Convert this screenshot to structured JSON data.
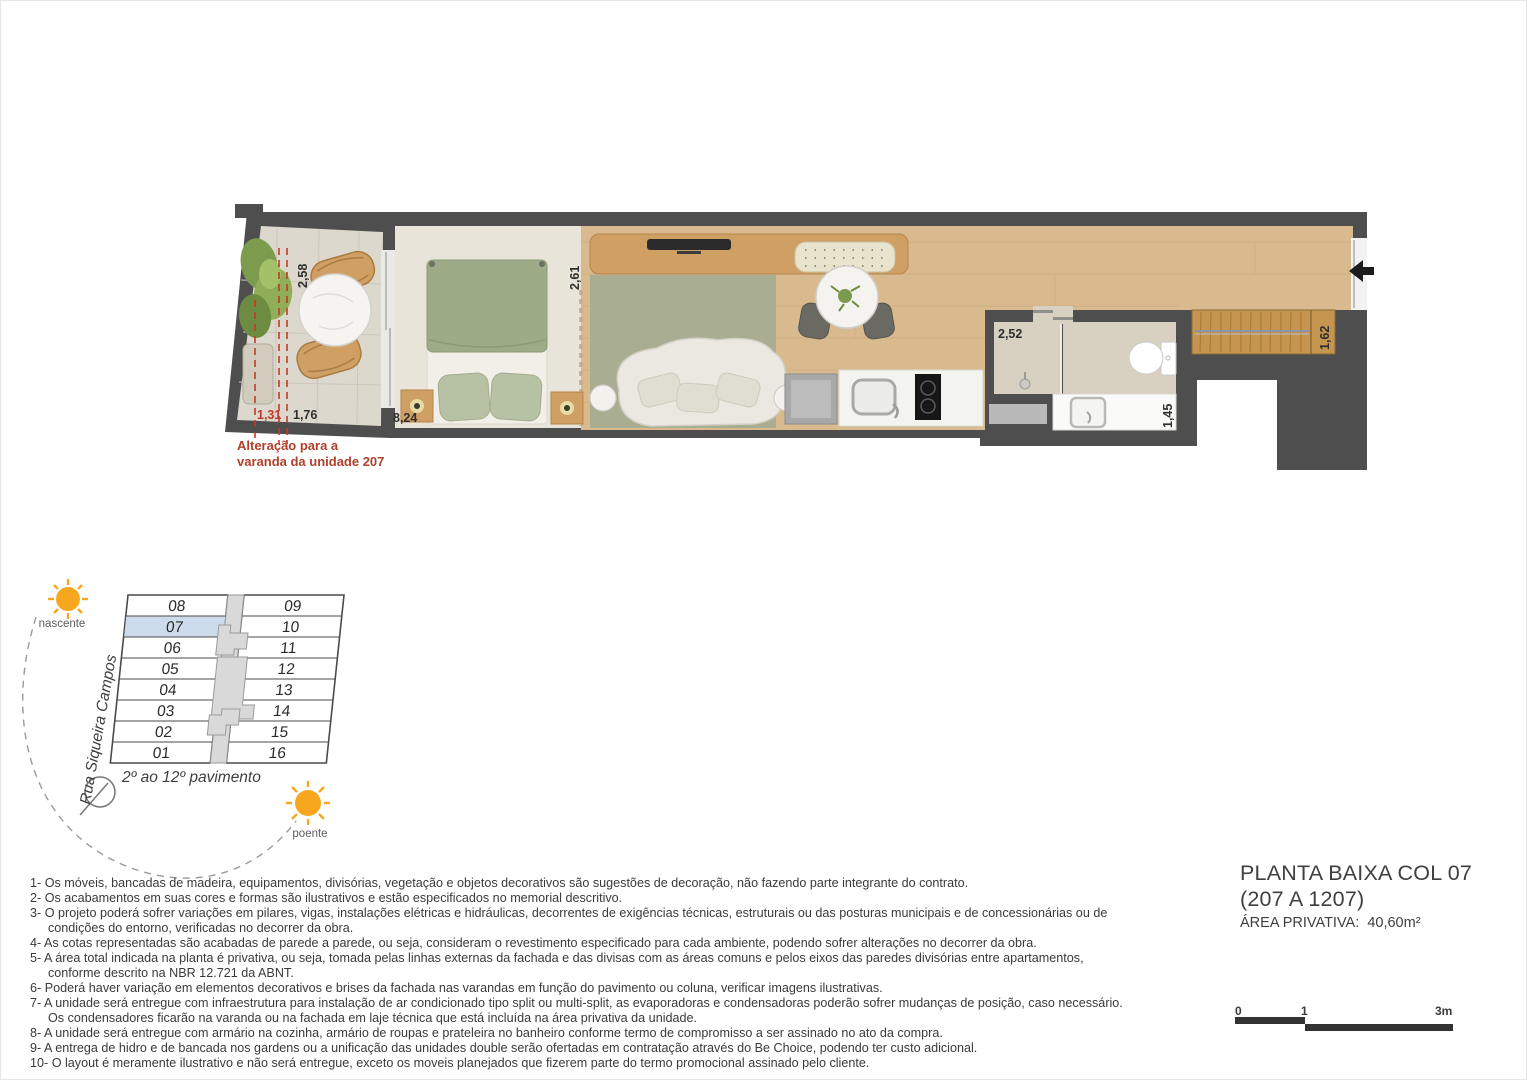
{
  "plan": {
    "dims": {
      "balcony_depth": "2,58",
      "alteration_width": "1,31",
      "balcony_width": "1,76",
      "unit_length": "8,24",
      "living_width": "2,61",
      "bath_width": "2,52",
      "bath_depth": "1,45",
      "closet_depth": "1,62"
    },
    "alteration_note": [
      "Alteração para a",
      "varanda da unidade 207"
    ],
    "colors": {
      "wall": "#4e4e4e",
      "wood_floor": "#d9ba8f",
      "rug": "#a9ae92",
      "alteration_red": "#b0402b",
      "dashed_red": "#c23a28"
    }
  },
  "keyplan": {
    "street": "Rua Siqueira Campos",
    "floors_label": "2º ao 12º pavimento",
    "sun_east_label": "nascente",
    "sun_west_label": "poente",
    "left_units": [
      "08",
      "07",
      "06",
      "05",
      "04",
      "03",
      "02",
      "01"
    ],
    "right_units": [
      "09",
      "10",
      "11",
      "12",
      "13",
      "14",
      "15",
      "16"
    ],
    "highlighted_unit": "07",
    "highlight_color": "#cddcec",
    "sun_color": "#f6a71d"
  },
  "titleblock": {
    "line1": "PLANTA BAIXA COL 07",
    "line2": "(207 A 1207)",
    "area_label": "ÁREA PRIVATIVA:",
    "area_value": "40,60m²"
  },
  "notes": [
    "1- Os móveis, bancadas de madeira, equipamentos, divisórias, vegetação e objetos decorativos são sugestões de decoração, não fazendo parte integrante do contrato.",
    "2- Os acabamentos em suas cores e formas são ilustrativos e estão especificados no memorial descritivo.",
    "3- O projeto poderá sofrer variações em pilares, vigas, instalações elétricas e hidráulicas, decorrentes de exigências técnicas, estruturais ou das posturas municipais e de concessionárias ou de condições do entorno, verificadas no decorrer da obra.",
    "4- As cotas representadas são acabadas de parede a parede, ou seja, consideram o revestimento especificado para cada ambiente, podendo sofrer alterações no decorrer da obra.",
    "5- A área total indicada na planta é privativa, ou seja, tomada pelas linhas externas da fachada e das divisas com as áreas comuns e pelos eixos das paredes divisórias entre apartamentos, conforme descrito na NBR 12.721 da ABNT.",
    "6- Poderá haver variação em elementos decorativos e brises da fachada nas varandas em função do pavimento ou coluna, verificar imagens ilustrativas.",
    "7- A unidade será entregue com infraestrutura para instalação de ar condicionado tipo split ou multi-split, as evaporadoras e condensadoras poderão sofrer mudanças de posição, caso necessário. Os condensadores ficarão na varanda ou na fachada em laje técnica que está incluída na área privativa da unidade.",
    "8- A unidade será entregue com armário na cozinha, armário de roupas e prateleira no banheiro conforme termo de compromisso a ser assinado no ato da compra.",
    "9- A entrega de hidro e de bancada nos gardens ou a unificação das unidades double serão ofertadas em contratação através do Be Choice, podendo ter custo adicional.",
    "10- O layout é meramente ilustrativo e não será entregue, exceto os moveis planejados que fizerem parte do termo promocional assinado pelo cliente."
  ],
  "scalebar": {
    "t0": "0",
    "t1": "1",
    "t3": "3m"
  },
  "icons": {
    "sun-icon": "☀",
    "north-arrow-icon": "◯",
    "entry-arrow-icon": "◄",
    "plant-icon": "❀"
  }
}
